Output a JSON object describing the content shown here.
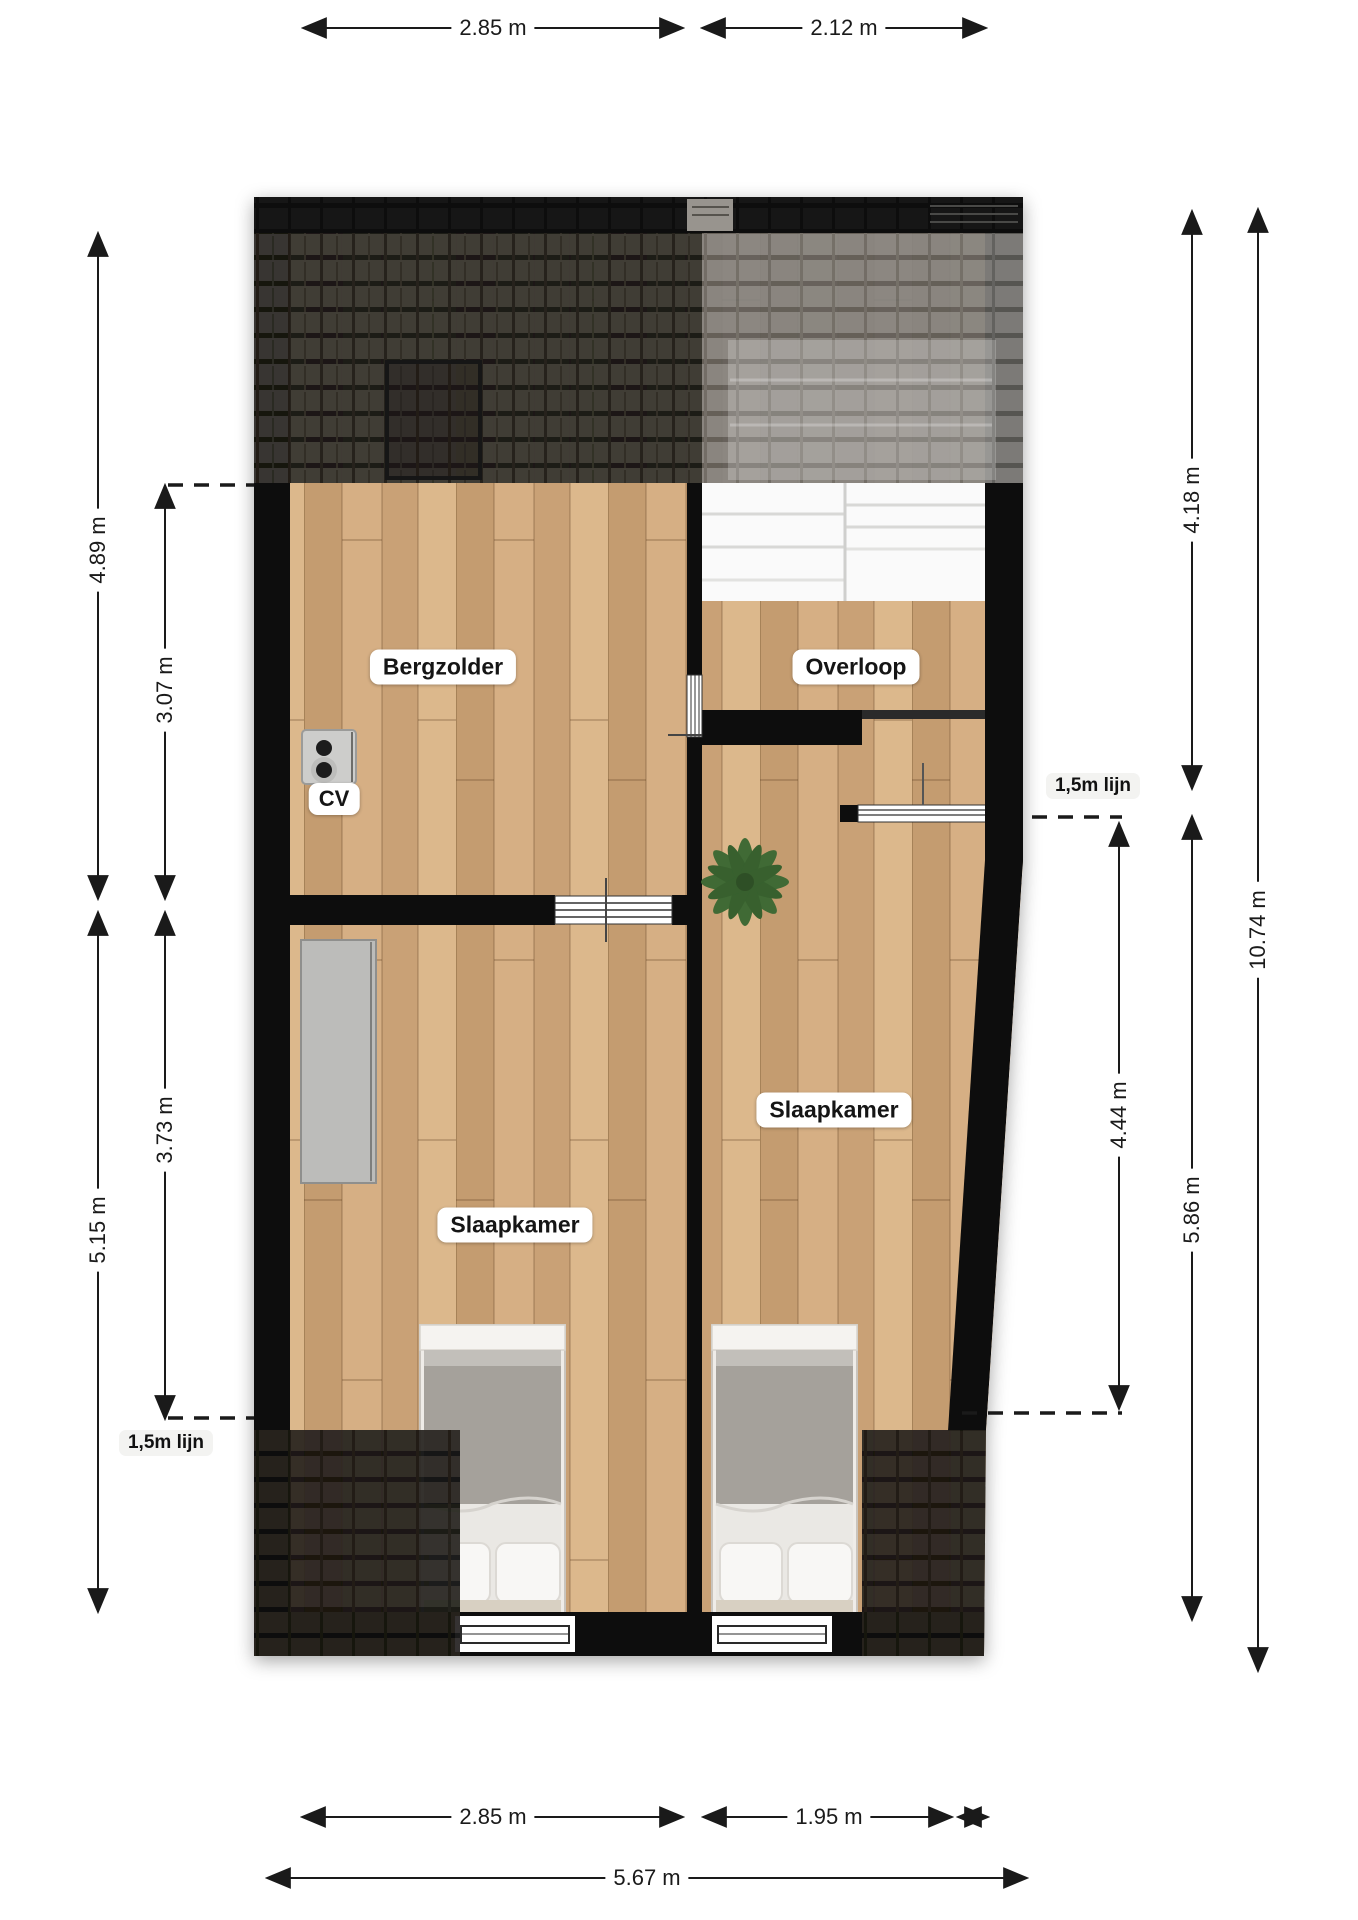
{
  "rooms": {
    "bergzolder": {
      "label": "Bergzolder"
    },
    "overloop": {
      "label": "Overloop"
    },
    "slaapkamer_left": {
      "label": "Slaapkamer"
    },
    "slaapkamer_right": {
      "label": "Slaapkamer"
    },
    "cv": {
      "label": "CV"
    }
  },
  "clearance_lines": {
    "right": "1,5m lijn",
    "left": "1,5m lijn"
  },
  "dimensions": {
    "top": {
      "left_section": "2.85 m",
      "right_section": "2.12 m"
    },
    "bottom": {
      "left_section": "2.85 m",
      "right_section": "1.95 m",
      "total": "5.67 m"
    },
    "left": {
      "outer_top": "4.89 m",
      "inner_top": "3.07 m",
      "inner_bottom": "3.73 m",
      "outer_bottom": "5.15 m"
    },
    "right": {
      "inner_top": "4.18 m",
      "attic_line": "4.44 m",
      "inner_bottom": "5.86 m",
      "outer_total": "10.74 m"
    }
  },
  "colors": {
    "wall": "#0d0d0c",
    "wood_floor": "#cfa87d",
    "roof_dark": "#35322c",
    "roof_gray": "#8b8a86",
    "dimension_line": "#1a1a1a",
    "label_background": "#ffffff"
  }
}
